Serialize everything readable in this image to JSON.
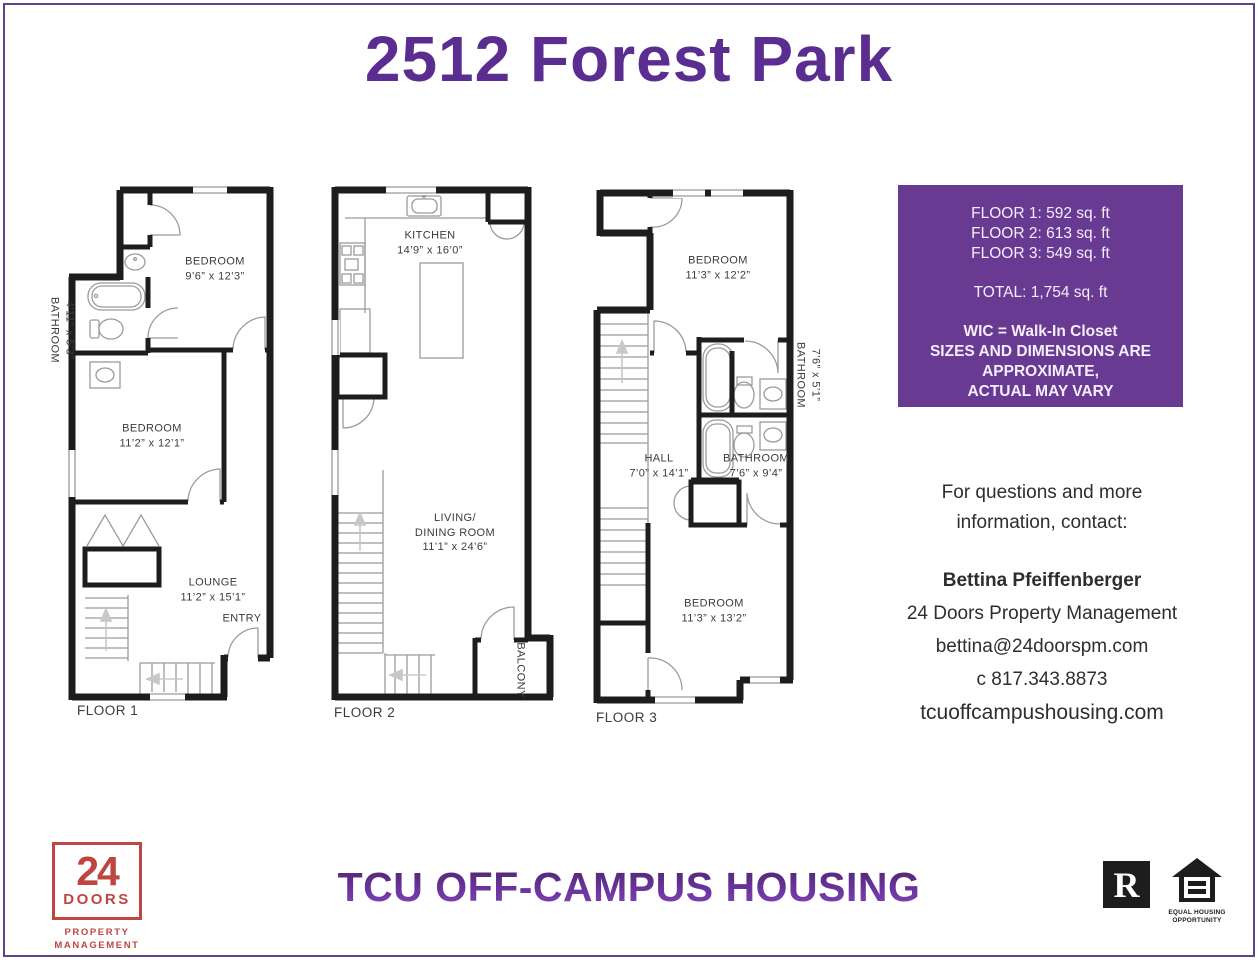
{
  "page": {
    "title": "2512 Forest Park",
    "footer_brand": "TCU OFF-CAMPUS HOUSING"
  },
  "info_box": {
    "bg_color": "#693a91",
    "lines": [
      "FLOOR 1: 592 sq. ft",
      "FLOOR 2: 613 sq. ft",
      "FLOOR 3: 549 sq. ft"
    ],
    "total": "TOTAL: 1,754 sq. ft",
    "notes": [
      "WIC = Walk-In Closet",
      "SIZES AND DIMENSIONS ARE",
      "APPROXIMATE,",
      "ACTUAL MAY VARY"
    ]
  },
  "contact": {
    "intro_line1": "For questions and more",
    "intro_line2": "information, contact:",
    "name": "Bettina Pfeiffenberger",
    "company": "24 Doors Property Management",
    "email": "bettina@24doorspm.com",
    "phone": "c  817.343.8873",
    "website": "tcuoffcampushousing.com"
  },
  "floors": [
    {
      "name": "FLOOR 1",
      "rooms": {
        "bedroom1": {
          "label": "BEDROOM",
          "dims": "9’6” x 12’3”"
        },
        "bathroom": {
          "label": "BATHROOM",
          "dims": "4’11” x 5’3”"
        },
        "bedroom2": {
          "label": "BEDROOM",
          "dims": "11’2” x 12’1”"
        },
        "lounge": {
          "label": "LOUNGE",
          "dims": "11’2” x 15’1”"
        },
        "entry": {
          "label": "ENTRY"
        }
      }
    },
    {
      "name": "FLOOR 2",
      "rooms": {
        "kitchen": {
          "label": "KITCHEN",
          "dims": "14’9” x 16’0”"
        },
        "living": {
          "label1": "LIVING/",
          "label2": "DINING ROOM",
          "dims": "11’1” x 24’6”"
        },
        "balcony": {
          "label": "BALCONY"
        }
      }
    },
    {
      "name": "FLOOR 3",
      "rooms": {
        "bedroom1": {
          "label": "BEDROOM",
          "dims": "11’3” x 12’2”"
        },
        "bathroom1": {
          "label": "BATHROOM",
          "dims": "7’6” x 5’1”"
        },
        "hall": {
          "label": "HALL",
          "dims": "7’0” x 14’1”"
        },
        "bathroom2": {
          "label": "BATHROOM",
          "dims": "7’6” x 9’4”"
        },
        "bedroom2": {
          "label": "BEDROOM",
          "dims": "11’3” x 13’2”"
        }
      }
    }
  ],
  "logos": {
    "doors24": {
      "number": "24",
      "name": "DOORS",
      "tagline1": "PROPERTY",
      "tagline2": "MANAGEMENT",
      "color": "#bf4540"
    },
    "realtor": {
      "letter": "R"
    },
    "equal_housing": {
      "line1": "EQUAL HOUSING",
      "line2": "OPPORTUNITY"
    }
  },
  "colors": {
    "purple": "#5c2d91",
    "purple_box": "#693a91",
    "red": "#bf4540",
    "walls": "#1d1d1d"
  }
}
